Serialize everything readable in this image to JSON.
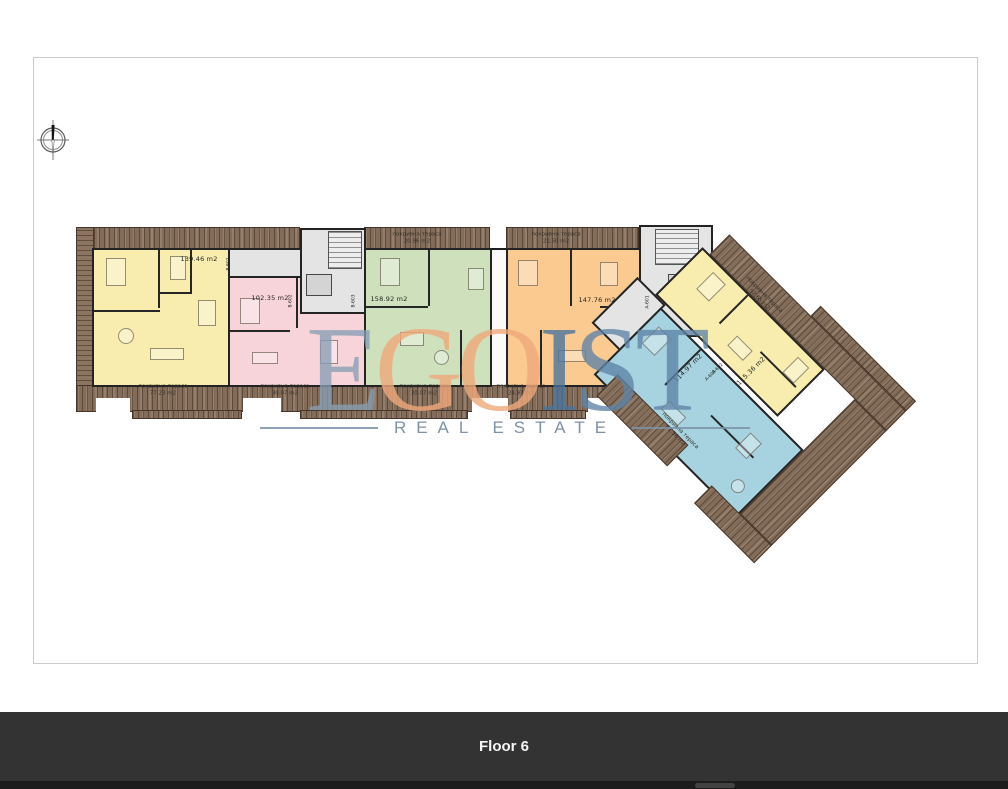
{
  "footer": {
    "label": "Floor 6"
  },
  "watermark": {
    "letters": [
      "E",
      "G",
      "O",
      "I",
      "S",
      "T"
    ],
    "subtitle": "REAL ESTATE"
  },
  "floorplan": {
    "compass_icon": "north-compass",
    "terrace_word": "покривна тераса",
    "areas": [
      "139.46 m2",
      "102.35 m2",
      "158.92 m2",
      "147.76 m2",
      "115.36 m2",
      "114.97 m2"
    ],
    "terraces": [
      "77.23 m2",
      "30.07 m2",
      "20.96 m2",
      "21.50 m2",
      "30.07 m2",
      "24.97 m2",
      "92.65 m2",
      "51.56 m2"
    ],
    "unit_tags": [
      "B-601",
      "B-602",
      "B-603",
      "A-601",
      "A-602",
      "A-603"
    ]
  },
  "colors": {
    "apartment_yellow": "#f8edae",
    "apartment_pink": "#f7d4d9",
    "apartment_green": "#cfe1bc",
    "apartment_orange": "#fbca90",
    "apartment_blue": "#a7d3e0",
    "terrace_wood": "#8b7460",
    "core_gray": "#e4e4e4",
    "footer_bg": "#333333",
    "watermark_blue": "#5e83a6",
    "watermark_orange": "#efa77c",
    "watermark_subtitle": "#72889f"
  }
}
